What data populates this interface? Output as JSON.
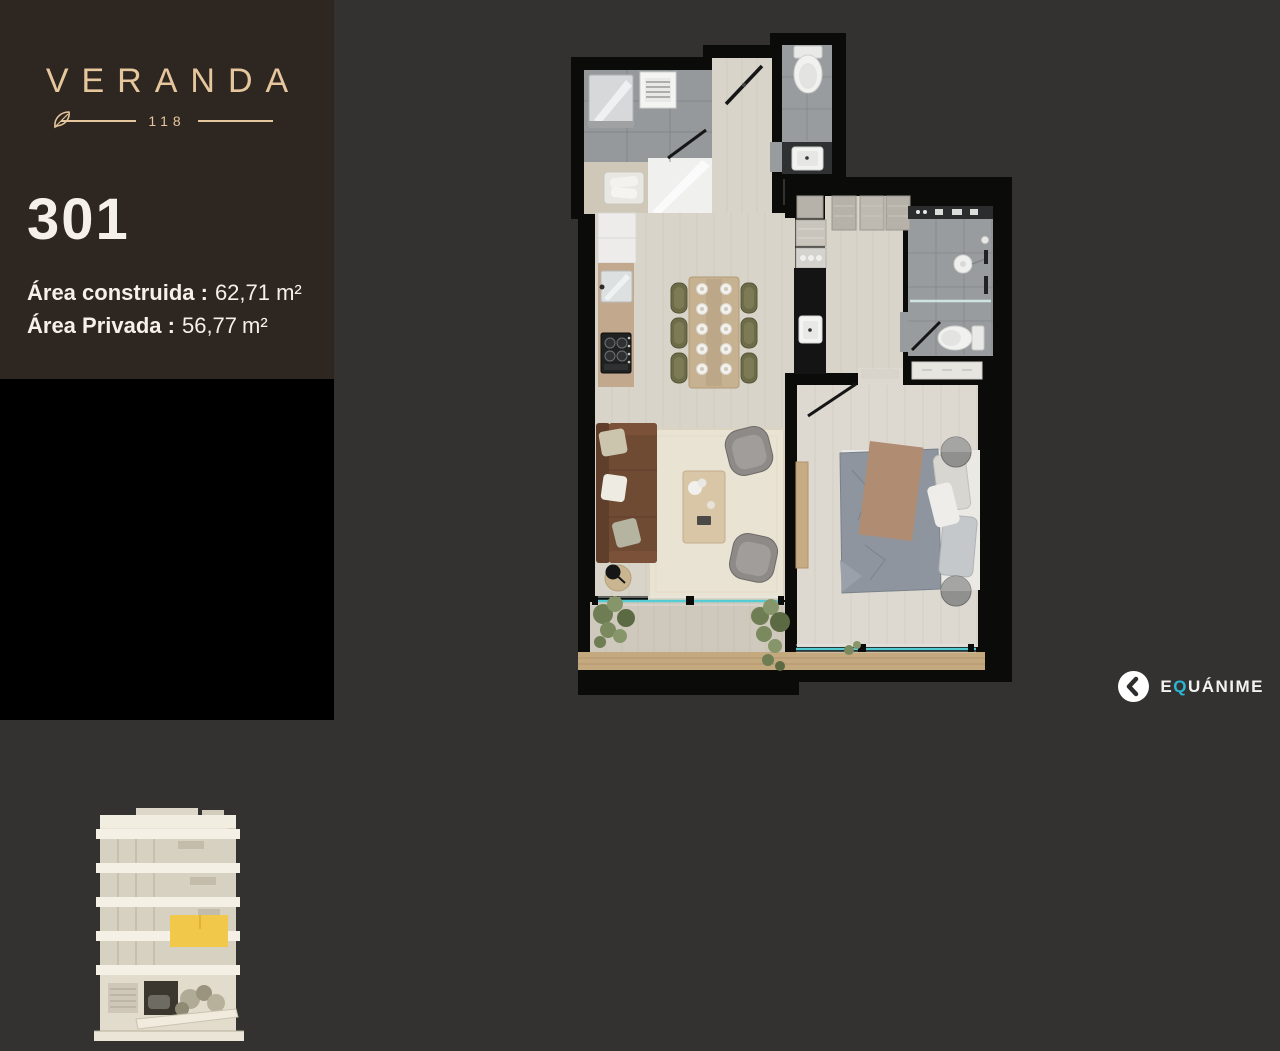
{
  "branding": {
    "logo_text": "VERANDA",
    "logo_number": "118",
    "leaf_icon": "leaf-icon",
    "logo_color": "#E6C79D"
  },
  "unit": {
    "number": "301"
  },
  "areas": {
    "built": {
      "label": "Área construida :",
      "value": "62,71 m²"
    },
    "private": {
      "label": "Área Privada :",
      "value": "56,77",
      "unit": "m²"
    }
  },
  "building_thumbnail": {
    "description": "building-elevation-with-highlighted-unit",
    "highlight_color": "#F2C84B"
  },
  "floor_plan": {
    "description": "top-view-apartment-render",
    "rooms": [
      "laundry-kitchen",
      "entry-hall",
      "bathroom-1",
      "walkin-closet",
      "bathroom-2",
      "kitchen-counter",
      "dining-area",
      "living-room",
      "bedroom",
      "balcony"
    ],
    "colors": {
      "walls": "#0B0B0A",
      "wood_floor": "#D8D4C9",
      "tile_floor": "#96999B",
      "glass_accent": "#54CCD4",
      "chair_olive": "#6D6C49",
      "sofa_brown": "#704B34"
    }
  },
  "publisher": {
    "prefix": "E",
    "accent_letter": "Q",
    "suffix": "UÁNIME",
    "accent_color": "#2AB7D8",
    "chevron_icon": "chevron-left-icon"
  },
  "page_colors": {
    "background": "#333230",
    "panel_brown": "#2E2620",
    "panel_black": "#000000"
  }
}
